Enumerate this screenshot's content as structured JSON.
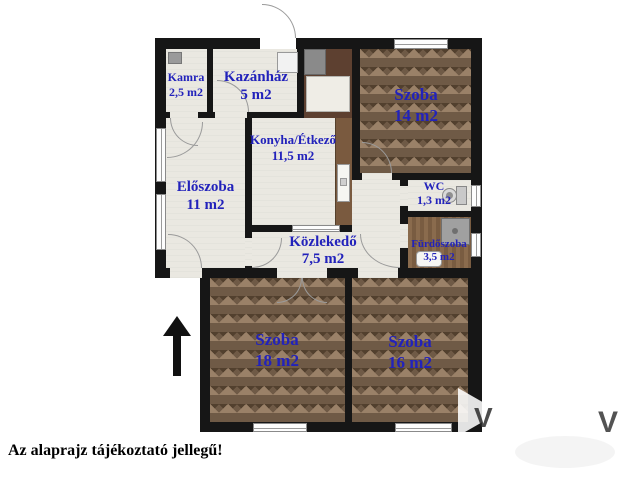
{
  "floorplan": {
    "rooms": [
      {
        "id": "kamra",
        "name": "Kamra",
        "area": "2,5 m2"
      },
      {
        "id": "kazanhaz",
        "name": "Kazánház",
        "area": "5 m2"
      },
      {
        "id": "szoba14",
        "name": "Szoba",
        "area": "14 m2"
      },
      {
        "id": "konyha",
        "name": "Konyha/Étkező",
        "area": "11,5 m2"
      },
      {
        "id": "eloszoba",
        "name": "Előszoba",
        "area": "11 m2"
      },
      {
        "id": "wc",
        "name": "WC",
        "area": "1,3 m2"
      },
      {
        "id": "kozlekedo",
        "name": "Közlekedő",
        "area": "7,5 m2"
      },
      {
        "id": "furdoszoba",
        "name": "Fürdőszoba",
        "area": "3,5 m2"
      },
      {
        "id": "szoba18",
        "name": "Szoba",
        "area": "18 m2"
      },
      {
        "id": "szoba16",
        "name": "Szoba",
        "area": "16 m2"
      }
    ],
    "note": "Az alaprajz tájékoztató jellegű!",
    "watermark_letter": "V",
    "colors": {
      "label": "#2222bb",
      "wall": "#161616",
      "parquet_base": "#6f5a46",
      "floor_light": "#eae8e1"
    }
  }
}
